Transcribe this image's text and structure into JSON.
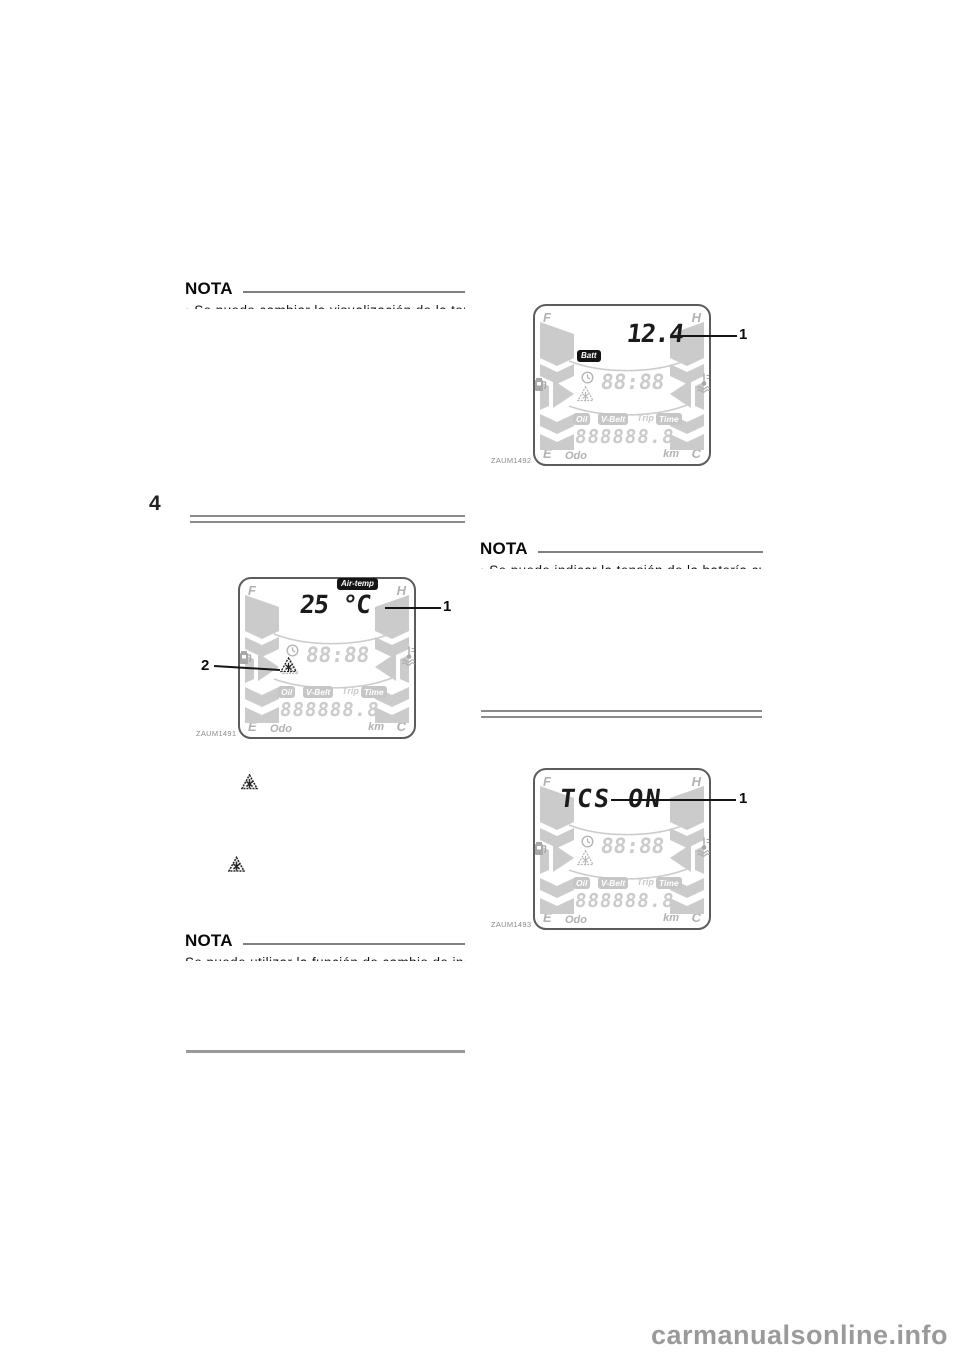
{
  "page": {
    "section_number": "4",
    "watermark": "carmanualsonline.info",
    "background_color": "#ffffff",
    "accent_dark": "#141414",
    "lcd_inactive_gray": "#c9c9c9"
  },
  "notes": [
    {
      "heading": "NOTA",
      "clipped_line": "• Se puede cambiar la visualización de la temperatura del indicador"
    },
    {
      "heading": "NOTA",
      "clipped_line": "• Se puede indicar la tensión de la batería cuando el vehículo"
    },
    {
      "heading": "NOTA",
      "clipped_line": "Se puede utilizar la función de cambio de indicación del sistema"
    }
  ],
  "lcd": {
    "corner_f": "F",
    "corner_h": "H",
    "corner_e": "E",
    "corner_c": "C",
    "odo_label": "Odo",
    "km_label": "km",
    "clock_value": "88:88",
    "odometer_value": "888888.8",
    "badges": {
      "oil": "Oil",
      "vbelt": "V-Belt",
      "trip": "Trip",
      "time": "Time"
    },
    "icons": [
      "fuel-pump-icon",
      "coolant-temp-icon",
      "clock-icon",
      "frost-warning-icon"
    ]
  },
  "figures": [
    {
      "caption": "ZAUM1492",
      "mode_badge": "Batt",
      "value": "12.4",
      "callout_1": "1"
    },
    {
      "caption": "ZAUM1491",
      "mode_badge": "Air-temp",
      "value": "25 °C",
      "callout_1": "1",
      "callout_2": "2"
    },
    {
      "caption": "ZAUM1493",
      "value": "TCS ON",
      "callout_1": "1"
    }
  ]
}
